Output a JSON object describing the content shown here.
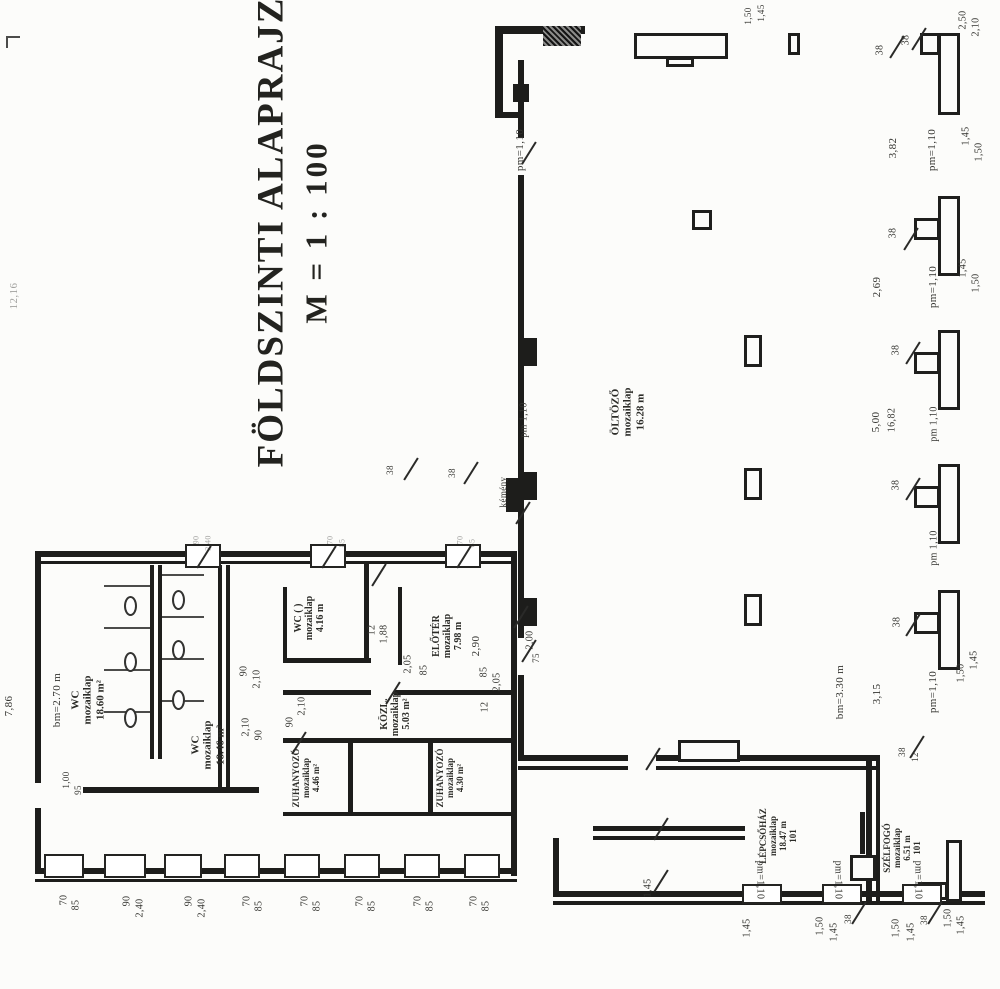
{
  "title": {
    "line1": "FÖLDSZINTI ALAPRAJZ",
    "line2": "M = 1 : 100"
  },
  "colors": {
    "ink": "#1d1d1b",
    "paper": "#fcfcfa",
    "label": "#33332f"
  },
  "rooms": [
    {
      "name": "wc-1",
      "lines": "WC\nmozaiklap\n18.60 m²",
      "x": 88,
      "y": 700,
      "s": 11
    },
    {
      "name": "wc-2",
      "lines": "WC\nmozaiklap\n18.46 m²",
      "x": 208,
      "y": 745,
      "s": 11
    },
    {
      "name": "wc-3",
      "lines": "WC ( )\nmozaiklap\n4.16 m",
      "x": 310,
      "y": 618,
      "s": 10
    },
    {
      "name": "eloter",
      "lines": "ELŐTÉR\nmozaiklap\n7.98 m",
      "x": 448,
      "y": 636,
      "s": 10
    },
    {
      "name": "kozl",
      "lines": "KÖZL.\nmozaiklap\n5.03 m²",
      "x": 396,
      "y": 714,
      "s": 10
    },
    {
      "name": "zuhanyozo-1",
      "lines": "ZUHANYOZÓ\nmozaiklap\n4.46 m²",
      "x": 306,
      "y": 778,
      "s": 9
    },
    {
      "name": "zuhanyozo-2",
      "lines": "ZUHANYOZÓ\nmozaiklap\n4.30 m²",
      "x": 450,
      "y": 778,
      "s": 9
    },
    {
      "name": "oltozo",
      "lines": "ÖLTÖZŐ\nmozaiklap\n16.28 m",
      "x": 628,
      "y": 412,
      "s": 11
    },
    {
      "name": "lepcsohaz",
      "lines": "LÉPCSŐHÁZ\nmozaiklap\n18.47 m\n101",
      "x": 778,
      "y": 836,
      "s": 9
    },
    {
      "name": "szelfogo",
      "lines": "SZÉLFOGÓ\nmozaiklap\n6.51 m\n101",
      "x": 902,
      "y": 848,
      "s": 9
    }
  ],
  "labels": [
    {
      "t": "12,16",
      "x": 14,
      "y": 296,
      "s": 11,
      "f": 1
    },
    {
      "t": "7,86",
      "x": 9,
      "y": 706,
      "s": 11
    },
    {
      "t": "bm=2.70 m",
      "x": 57,
      "y": 700,
      "s": 11
    },
    {
      "t": "1,00",
      "x": 66,
      "y": 780,
      "s": 9
    },
    {
      "t": "95",
      "x": 78,
      "y": 790,
      "s": 9
    },
    {
      "t": "90",
      "x": 244,
      "y": 671,
      "s": 10
    },
    {
      "t": "2,10",
      "x": 257,
      "y": 679,
      "s": 10
    },
    {
      "t": "2,10",
      "x": 246,
      "y": 727,
      "s": 10
    },
    {
      "t": "90",
      "x": 259,
      "y": 735,
      "s": 10
    },
    {
      "t": "12",
      "x": 372,
      "y": 630,
      "s": 10
    },
    {
      "t": "1,88",
      "x": 384,
      "y": 634,
      "s": 10
    },
    {
      "t": "2,90",
      "x": 476,
      "y": 646,
      "s": 11
    },
    {
      "t": "2,05",
      "x": 408,
      "y": 664,
      "s": 10
    },
    {
      "t": "85",
      "x": 424,
      "y": 670,
      "s": 10
    },
    {
      "t": "85",
      "x": 484,
      "y": 672,
      "s": 10
    },
    {
      "t": "2,05",
      "x": 497,
      "y": 682,
      "s": 10
    },
    {
      "t": "12",
      "x": 485,
      "y": 707,
      "s": 10
    },
    {
      "t": "2,00",
      "x": 530,
      "y": 640,
      "s": 10
    },
    {
      "t": "75",
      "x": 536,
      "y": 658,
      "s": 9
    },
    {
      "t": "90",
      "x": 290,
      "y": 722,
      "s": 10
    },
    {
      "t": "2,10",
      "x": 302,
      "y": 706,
      "s": 10
    },
    {
      "t": "pm=1,10",
      "x": 520,
      "y": 150,
      "s": 11
    },
    {
      "t": "pm 1,10",
      "x": 524,
      "y": 420,
      "s": 10
    },
    {
      "t": "kémény",
      "x": 503,
      "y": 492,
      "s": 9
    },
    {
      "t": "38",
      "x": 390,
      "y": 470,
      "s": 9
    },
    {
      "t": "38",
      "x": 452,
      "y": 473,
      "s": 9
    },
    {
      "t": "1,50",
      "x": 748,
      "y": 16,
      "s": 9
    },
    {
      "t": "1,45",
      "x": 761,
      "y": 13,
      "s": 9
    },
    {
      "t": "2,50",
      "x": 963,
      "y": 20,
      "s": 10
    },
    {
      "t": "2,10",
      "x": 976,
      "y": 27,
      "s": 10
    },
    {
      "t": "38",
      "x": 880,
      "y": 50,
      "s": 10
    },
    {
      "t": "38",
      "x": 906,
      "y": 40,
      "s": 10
    },
    {
      "t": "3,82",
      "x": 893,
      "y": 148,
      "s": 11
    },
    {
      "t": "pm=1,10",
      "x": 932,
      "y": 150,
      "s": 11
    },
    {
      "t": "1,45",
      "x": 966,
      "y": 136,
      "s": 10
    },
    {
      "t": "1,50",
      "x": 979,
      "y": 152,
      "s": 10
    },
    {
      "t": "38",
      "x": 893,
      "y": 233,
      "s": 10
    },
    {
      "t": "2,69",
      "x": 877,
      "y": 287,
      "s": 11
    },
    {
      "t": "pm=1,10",
      "x": 933,
      "y": 287,
      "s": 11
    },
    {
      "t": "1,45",
      "x": 963,
      "y": 268,
      "s": 10
    },
    {
      "t": "1,50",
      "x": 976,
      "y": 283,
      "s": 10
    },
    {
      "t": "38",
      "x": 896,
      "y": 350,
      "s": 10
    },
    {
      "t": "5,00",
      "x": 876,
      "y": 422,
      "s": 11
    },
    {
      "t": "16,82",
      "x": 892,
      "y": 420,
      "s": 10
    },
    {
      "t": "pm 1,10",
      "x": 934,
      "y": 424,
      "s": 10
    },
    {
      "t": "38",
      "x": 896,
      "y": 485,
      "s": 10
    },
    {
      "t": "pm 1,10",
      "x": 934,
      "y": 548,
      "s": 10
    },
    {
      "t": "38",
      "x": 897,
      "y": 622,
      "s": 10
    },
    {
      "t": "3,15",
      "x": 877,
      "y": 694,
      "s": 11
    },
    {
      "t": "pm=1,10",
      "x": 933,
      "y": 692,
      "s": 11
    },
    {
      "t": "1,50",
      "x": 961,
      "y": 673,
      "s": 10
    },
    {
      "t": "1,45",
      "x": 974,
      "y": 660,
      "s": 10
    },
    {
      "t": "bm=3.30 m",
      "x": 840,
      "y": 692,
      "s": 11
    },
    {
      "t": "38",
      "x": 902,
      "y": 752,
      "s": 9
    },
    {
      "t": "12",
      "x": 915,
      "y": 757,
      "s": 9
    },
    {
      "t": "1,45",
      "x": 648,
      "y": 888,
      "s": 10
    },
    {
      "t": "pm=1,10",
      "x": 760,
      "y": 880,
      "s": 10,
      "r": 90
    },
    {
      "t": "pm=1,10",
      "x": 838,
      "y": 880,
      "s": 10,
      "r": 90
    },
    {
      "t": "pm=1,10",
      "x": 918,
      "y": 880,
      "s": 10,
      "r": 90
    },
    {
      "t": "1,45",
      "x": 747,
      "y": 928,
      "s": 10
    },
    {
      "t": "1,50",
      "x": 820,
      "y": 926,
      "s": 10
    },
    {
      "t": "1,45",
      "x": 834,
      "y": 932,
      "s": 10
    },
    {
      "t": "38",
      "x": 848,
      "y": 919,
      "s": 9
    },
    {
      "t": "1,50",
      "x": 896,
      "y": 928,
      "s": 10
    },
    {
      "t": "1,45",
      "x": 911,
      "y": 932,
      "s": 10
    },
    {
      "t": "38",
      "x": 924,
      "y": 920,
      "s": 9
    },
    {
      "t": "1,50",
      "x": 948,
      "y": 918,
      "s": 10
    },
    {
      "t": "1,45",
      "x": 961,
      "y": 925,
      "s": 10
    },
    {
      "t": "70",
      "x": 64,
      "y": 900,
      "s": 10
    },
    {
      "t": "85",
      "x": 76,
      "y": 905,
      "s": 10
    },
    {
      "t": "90",
      "x": 127,
      "y": 901,
      "s": 10
    },
    {
      "t": "2,40",
      "x": 140,
      "y": 908,
      "s": 10
    },
    {
      "t": "90",
      "x": 189,
      "y": 901,
      "s": 10
    },
    {
      "t": "2,40",
      "x": 202,
      "y": 908,
      "s": 10
    },
    {
      "t": "70",
      "x": 247,
      "y": 901,
      "s": 10
    },
    {
      "t": "85",
      "x": 259,
      "y": 906,
      "s": 10
    },
    {
      "t": "70",
      "x": 305,
      "y": 901,
      "s": 10
    },
    {
      "t": "85",
      "x": 317,
      "y": 906,
      "s": 10
    },
    {
      "t": "70",
      "x": 360,
      "y": 901,
      "s": 10
    },
    {
      "t": "85",
      "x": 372,
      "y": 906,
      "s": 10
    },
    {
      "t": "70",
      "x": 418,
      "y": 901,
      "s": 10
    },
    {
      "t": "85",
      "x": 430,
      "y": 906,
      "s": 10
    },
    {
      "t": "70",
      "x": 474,
      "y": 901,
      "s": 10
    },
    {
      "t": "85",
      "x": 486,
      "y": 906,
      "s": 10
    },
    {
      "t": "90",
      "x": 196,
      "y": 540,
      "s": 8,
      "f": 1
    },
    {
      "t": "2,40",
      "x": 208,
      "y": 543,
      "s": 8,
      "f": 1
    },
    {
      "t": "70",
      "x": 330,
      "y": 540,
      "s": 8,
      "f": 1
    },
    {
      "t": "85",
      "x": 342,
      "y": 543,
      "s": 8,
      "f": 1
    },
    {
      "t": "70",
      "x": 460,
      "y": 540,
      "s": 8,
      "f": 1
    },
    {
      "t": "85",
      "x": 472,
      "y": 543,
      "s": 8,
      "f": 1
    }
  ],
  "plan": {
    "walls": [
      [
        35,
        551,
        482,
        6
      ],
      [
        35,
        561,
        482,
        3
      ],
      [
        35,
        551,
        6,
        232
      ],
      [
        35,
        808,
        6,
        66
      ],
      [
        511,
        551,
        6,
        325
      ],
      [
        35,
        868,
        482,
        6
      ],
      [
        35,
        879,
        482,
        3
      ],
      [
        150,
        565,
        4,
        194
      ],
      [
        158,
        565,
        4,
        194
      ],
      [
        83,
        787,
        176,
        6
      ],
      [
        218,
        565,
        4,
        224
      ],
      [
        226,
        565,
        4,
        224
      ],
      [
        283,
        587,
        4,
        76
      ],
      [
        283,
        658,
        88,
        5
      ],
      [
        364,
        563,
        5,
        100
      ],
      [
        398,
        587,
        4,
        78
      ],
      [
        283,
        690,
        88,
        5
      ],
      [
        394,
        690,
        119,
        5
      ],
      [
        283,
        738,
        230,
        5
      ],
      [
        348,
        738,
        5,
        76
      ],
      [
        428,
        738,
        5,
        76
      ],
      [
        283,
        812,
        230,
        4
      ],
      [
        518,
        60,
        6,
        78
      ],
      [
        518,
        175,
        6,
        463
      ],
      [
        518,
        675,
        6,
        82
      ],
      [
        524,
        338,
        13,
        28
      ],
      [
        524,
        472,
        13,
        28
      ],
      [
        524,
        598,
        13,
        28
      ],
      [
        506,
        478,
        12,
        34
      ],
      [
        495,
        26,
        90,
        8
      ],
      [
        495,
        26,
        8,
        92
      ],
      [
        495,
        112,
        24,
        6
      ],
      [
        513,
        84,
        16,
        18
      ],
      [
        518,
        755,
        110,
        6
      ],
      [
        656,
        755,
        224,
        6
      ],
      [
        518,
        766,
        110,
        4
      ],
      [
        656,
        766,
        224,
        4
      ],
      [
        866,
        755,
        6,
        150
      ],
      [
        876,
        755,
        4,
        150
      ],
      [
        593,
        826,
        152,
        5
      ],
      [
        593,
        836,
        152,
        4
      ],
      [
        553,
        891,
        432,
        6
      ],
      [
        553,
        901,
        432,
        4
      ],
      [
        553,
        838,
        6,
        58
      ],
      [
        860,
        812,
        5,
        42
      ]
    ],
    "outlines": [
      [
        634,
        33,
        94,
        26
      ],
      [
        666,
        57,
        28,
        10
      ],
      [
        788,
        33,
        12,
        22
      ],
      [
        678,
        740,
        62,
        22
      ],
      [
        692,
        210,
        20,
        20
      ],
      [
        744,
        335,
        18,
        32
      ],
      [
        744,
        468,
        18,
        32
      ],
      [
        744,
        594,
        18,
        32
      ],
      [
        938,
        33,
        22,
        82
      ],
      [
        920,
        33,
        20,
        22
      ],
      [
        938,
        196,
        22,
        80
      ],
      [
        914,
        218,
        26,
        22
      ],
      [
        938,
        330,
        22,
        80
      ],
      [
        914,
        352,
        26,
        22
      ],
      [
        938,
        464,
        22,
        80
      ],
      [
        914,
        486,
        26,
        22
      ],
      [
        938,
        590,
        22,
        80
      ],
      [
        914,
        612,
        26,
        22
      ],
      [
        946,
        840,
        16,
        62
      ],
      [
        918,
        882,
        30,
        18
      ],
      [
        850,
        855,
        26,
        26
      ]
    ],
    "hatch": [
      [
        543,
        26,
        38,
        20
      ]
    ],
    "windows_slashed": [
      [
        185,
        544,
        36,
        24
      ],
      [
        310,
        544,
        36,
        24
      ],
      [
        445,
        544,
        36,
        24
      ]
    ],
    "windows": [
      [
        44,
        854,
        40,
        24
      ],
      [
        104,
        854,
        42,
        24
      ],
      [
        164,
        854,
        38,
        24
      ],
      [
        224,
        854,
        36,
        24
      ],
      [
        284,
        854,
        36,
        24
      ],
      [
        344,
        854,
        36,
        24
      ],
      [
        404,
        854,
        36,
        24
      ],
      [
        464,
        854,
        36,
        24
      ],
      [
        742,
        884,
        40,
        20
      ],
      [
        822,
        884,
        40,
        20
      ],
      [
        902,
        884,
        40,
        20
      ]
    ],
    "slashes": [
      [
        516,
        152
      ],
      [
        516,
        650
      ],
      [
        508,
        616
      ],
      [
        380,
        692
      ],
      [
        366,
        574
      ],
      [
        640,
        758
      ],
      [
        648,
        828
      ],
      [
        398,
        468
      ],
      [
        458,
        472
      ],
      [
        884,
        46
      ],
      [
        906,
        38
      ],
      [
        898,
        238
      ],
      [
        900,
        352
      ],
      [
        900,
        488
      ],
      [
        900,
        624
      ],
      [
        904,
        746
      ],
      [
        648,
        880
      ],
      [
        922,
        912
      ],
      [
        846,
        912
      ],
      [
        286,
        742
      ],
      [
        510,
        512
      ]
    ],
    "ticks": [
      [
        104,
        585,
        46,
        2
      ],
      [
        104,
        627,
        46,
        2
      ],
      [
        104,
        669,
        46,
        2
      ],
      [
        104,
        711,
        46,
        2
      ],
      [
        162,
        574,
        42,
        2
      ],
      [
        162,
        616,
        42,
        2
      ],
      [
        162,
        658,
        42,
        2
      ],
      [
        162,
        700,
        42,
        2
      ],
      [
        6,
        36,
        14,
        2
      ],
      [
        6,
        36,
        2,
        12
      ]
    ],
    "toilets": [
      [
        124,
        596
      ],
      [
        124,
        652
      ],
      [
        124,
        708
      ],
      [
        172,
        590
      ],
      [
        172,
        640
      ],
      [
        172,
        690
      ]
    ]
  }
}
